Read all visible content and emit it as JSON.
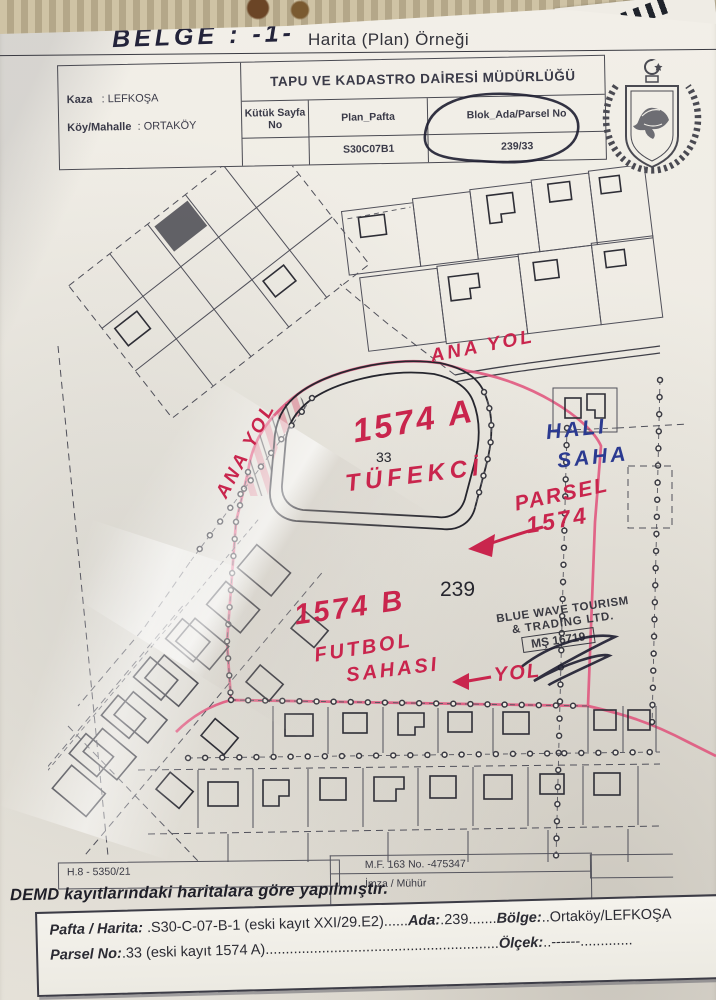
{
  "doc": {
    "belge_label": "BELGE : -1-",
    "title": "Harita (Plan) Örneği",
    "header": {
      "office_title": "TAPU VE KADASTRO DAİRESİ MÜDÜRLÜĞÜ",
      "kaza_label": "Kaza",
      "kaza_value": ": LEFKOŞA",
      "koy_label": "Köy/Mahalle",
      "koy_value": ": ORTAKÖY",
      "col1": "Kütük Sayfa No",
      "col2": "Plan_Pafta",
      "col3": "Blok_Ada/Parsel No",
      "plan_pafta_value": "S30C07B1",
      "blok_ada_parsel_value": "239/33"
    },
    "map_annotations": {
      "ana_yol_top": "ANA YOL",
      "ana_yol_left": "ANA YOL",
      "parcel_a": "1574 A",
      "parcel_a_number": "33",
      "tufekci": "TÜFEKCİ",
      "parsel_line1": "PARSEL",
      "parsel_line2": "1574",
      "hali_saha_line1": "HALI",
      "hali_saha_line2": "SAHA",
      "block_number": "239",
      "parcel_b": "1574 B",
      "futbol_line1": "FUTBOL",
      "futbol_line2": "SAHASI",
      "yol": "YOL",
      "stamp_line1": "BLUE WAVE TOURISM",
      "stamp_line2": "& TRADING LTD.",
      "stamp_line3": "MŞ 16719"
    },
    "footer": {
      "ref_left": "H.8 - 5350/21",
      "ref_mid": "M.F. 163 No. -475347",
      "imza_muhur": "İmza / Mühür",
      "demd_note": "DEMD kayıtlarındaki haritalara göre yapılmıştır.",
      "pafta_label": "Pafta / Harita:",
      "pafta_value": " .S30-C-07-B-1 (eski kayıt XXI/29.E2)......",
      "ada_label": "Ada:",
      "ada_value": ".239.......",
      "bolge_label": "Bölge:",
      "bolge_value": "..Ortaköy/LEFKOŞA",
      "parsel_label": "Parsel No:",
      "parsel_value": ".33 (eski kayıt 1574 A)..........................................................",
      "olcek_label": "Ölçek:",
      "olcek_value": "..------............."
    },
    "colors": {
      "red_ink": "#c9254d",
      "pink_marker": "#e0507a",
      "blue_ink": "#2b3a90",
      "print_gray": "#3a3a48"
    }
  }
}
